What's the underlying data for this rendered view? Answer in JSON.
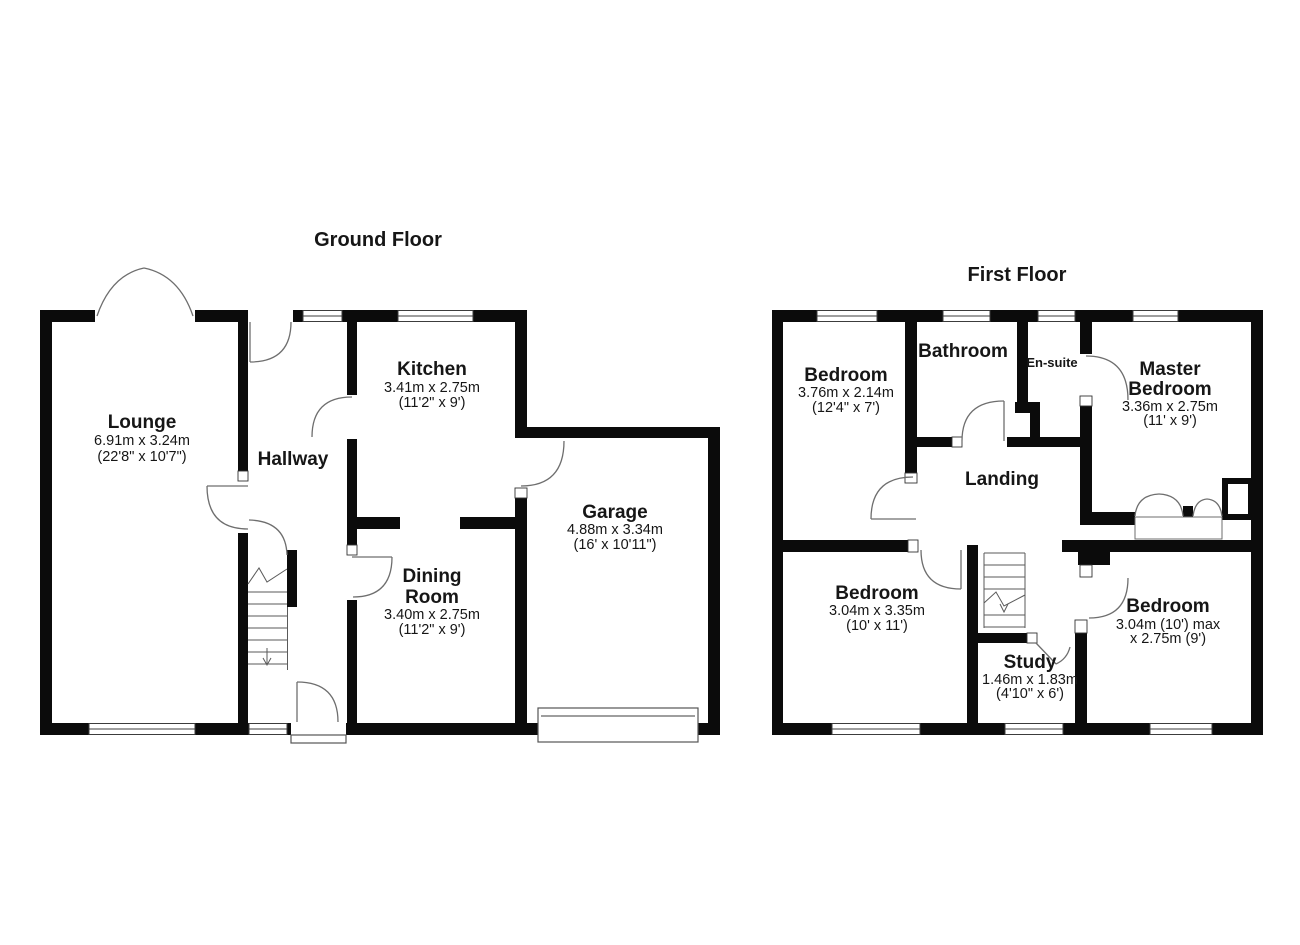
{
  "colors": {
    "wall": "#0b0b0b",
    "door_arc": "#6e6e6e",
    "text": "#161616",
    "background": "#ffffff"
  },
  "ground_floor": {
    "title": "Ground Floor",
    "rooms": {
      "lounge": {
        "name": "Lounge",
        "metric": "6.91m x 3.24m",
        "imperial": "(22'8\" x 10'7\")"
      },
      "hallway": {
        "name": "Hallway"
      },
      "kitchen": {
        "name": "Kitchen",
        "metric": "3.41m x 2.75m",
        "imperial": "(11'2\" x 9')"
      },
      "dining_room": {
        "name_line1": "Dining",
        "name_line2": "Room",
        "metric": "3.40m x 2.75m",
        "imperial": "(11'2\" x 9')"
      },
      "garage": {
        "name": "Garage",
        "metric": "4.88m x 3.34m",
        "imperial": "(16' x 10'11\")"
      }
    }
  },
  "first_floor": {
    "title": "First Floor",
    "rooms": {
      "bedroom_top_left": {
        "name": "Bedroom",
        "metric": "3.76m x 2.14m",
        "imperial": "(12'4\" x 7')"
      },
      "bathroom": {
        "name": "Bathroom"
      },
      "en_suite": {
        "name": "En-suite"
      },
      "master_bedroom": {
        "name_line1": "Master",
        "name_line2": "Bedroom",
        "metric": "3.36m x 2.75m",
        "imperial": "(11' x 9')"
      },
      "landing": {
        "name": "Landing"
      },
      "bedroom_bottom_left": {
        "name": "Bedroom",
        "metric": "3.04m x 3.35m",
        "imperial": "(10' x 11')"
      },
      "study": {
        "name": "Study",
        "metric": "1.46m x 1.83m",
        "imperial": "(4'10\" x 6')"
      },
      "bedroom_bottom_right": {
        "name": "Bedroom",
        "metric_line1": "3.04m (10') max",
        "metric_line2": "x 2.75m (9')"
      }
    }
  }
}
